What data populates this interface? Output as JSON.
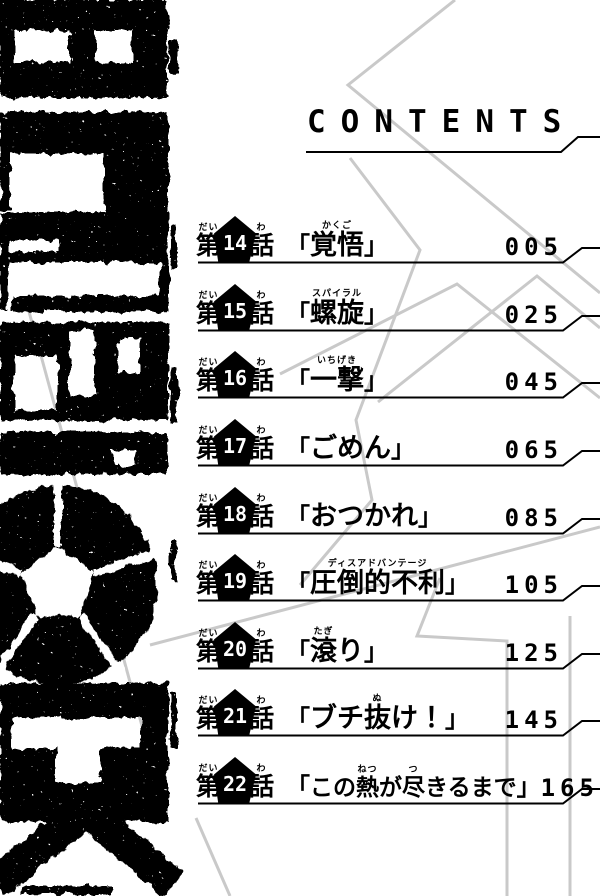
{
  "page": {
    "colors": {
      "ink": "#000000",
      "background": "#ffffff",
      "zigzag_gray": "#c9c9c9"
    }
  },
  "header": {
    "title": "CONTENTS"
  },
  "logo": {
    "text": "BLUELOCK"
  },
  "toc": {
    "chapter_prefix": "第",
    "chapter_prefix_ruby": "だい",
    "chapter_suffix": "話",
    "chapter_suffix_ruby": "わ",
    "open_bracket": "「",
    "close_bracket": "」",
    "entries": [
      {
        "number": "14",
        "page": "005",
        "segments": [
          {
            "text": "覚悟",
            "ruby": "かくご"
          }
        ]
      },
      {
        "number": "15",
        "page": "025",
        "segments": [
          {
            "text": "螺旋",
            "ruby": "スパイラル"
          }
        ]
      },
      {
        "number": "16",
        "page": "045",
        "segments": [
          {
            "text": "一撃",
            "ruby": "いちげき"
          }
        ]
      },
      {
        "number": "17",
        "page": "065",
        "segments": [
          {
            "text": "ごめん"
          }
        ]
      },
      {
        "number": "18",
        "page": "085",
        "segments": [
          {
            "text": "おつかれ"
          }
        ]
      },
      {
        "number": "19",
        "page": "105",
        "segments": [
          {
            "text": "圧倒的不利",
            "ruby": "ディスアドバンテージ"
          }
        ]
      },
      {
        "number": "20",
        "page": "125",
        "segments": [
          {
            "text": "滾",
            "ruby": "たぎ"
          },
          {
            "text": "り"
          }
        ]
      },
      {
        "number": "21",
        "page": "145",
        "segments": [
          {
            "text": "ブチ"
          },
          {
            "text": "抜",
            "ruby": "ぬ"
          },
          {
            "text": "け！"
          }
        ]
      },
      {
        "number": "22",
        "page": "165",
        "long": true,
        "segments": [
          {
            "text": "この"
          },
          {
            "text": "熱",
            "ruby": "ねつ"
          },
          {
            "text": "が"
          },
          {
            "text": "尽",
            "ruby": "つ"
          },
          {
            "text": "きるまで"
          }
        ]
      }
    ]
  }
}
